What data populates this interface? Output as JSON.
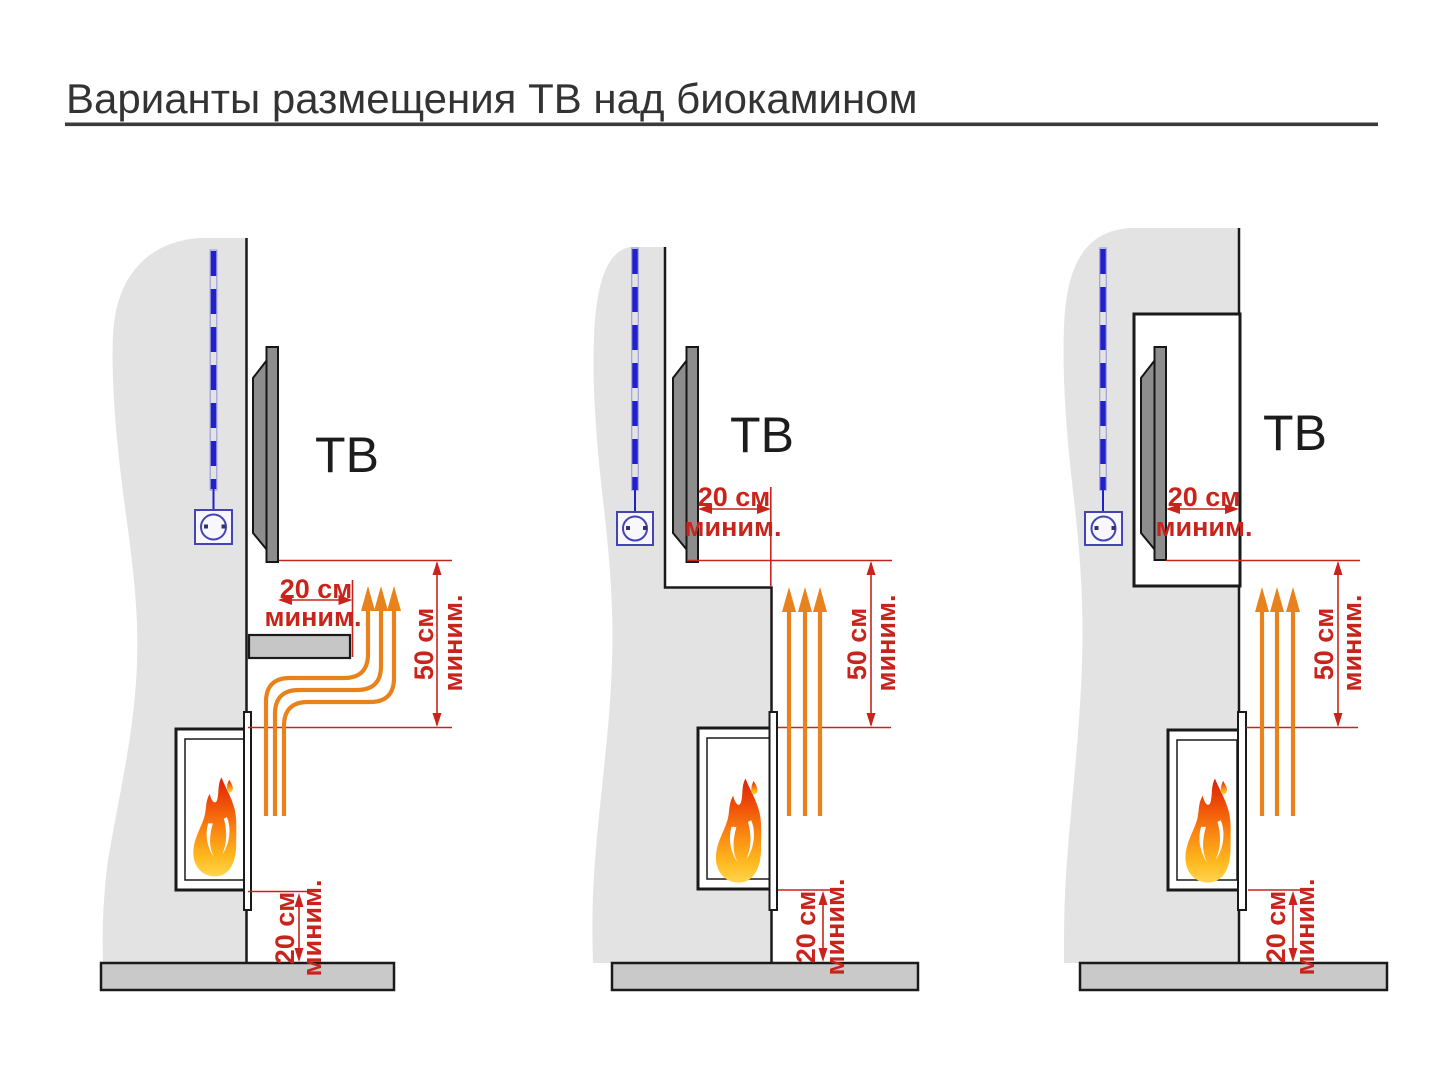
{
  "title": "Варианты размещения ТВ над биокамином",
  "colors": {
    "dimension_red": "#c9241b",
    "heat_arrow_orange": "#e8821c",
    "cable_blue": "#2121cc",
    "outlet_indigo": "#4444b4",
    "wall_gray": "#e3e3e3",
    "floor_gray": "#c9c9c9",
    "tv_gray": "#8d8d8d",
    "outline_black": "#1a1a1a",
    "flame_red": "#dd2006",
    "flame_yellow": "#ffd54f"
  },
  "icons": {
    "flame": "flame-icon",
    "power_outlet": "power-outlet-icon",
    "power_cable": "dashed-cable-icon",
    "heat_flow": "heat-arrows-icon"
  },
  "panels": [
    {
      "tv_label": "ТВ",
      "front_clearance": {
        "value": "20 см",
        "qualifier": "миним."
      },
      "vertical_clearance": {
        "value": "50 см",
        "qualifier": "миним."
      },
      "floor_clearance": {
        "value": "20 см",
        "qualifier": "миним."
      }
    },
    {
      "tv_label": "ТВ",
      "front_clearance": {
        "value": "20 см",
        "qualifier": "миним."
      },
      "vertical_clearance": {
        "value": "50 см",
        "qualifier": "миним."
      },
      "floor_clearance": {
        "value": "20 см",
        "qualifier": "миним."
      }
    },
    {
      "tv_label": "ТВ",
      "front_clearance": {
        "value": "20 см",
        "qualifier": "миним."
      },
      "vertical_clearance": {
        "value": "50 см",
        "qualifier": "миним."
      },
      "floor_clearance": {
        "value": "20 см",
        "qualifier": "миним."
      }
    }
  ]
}
